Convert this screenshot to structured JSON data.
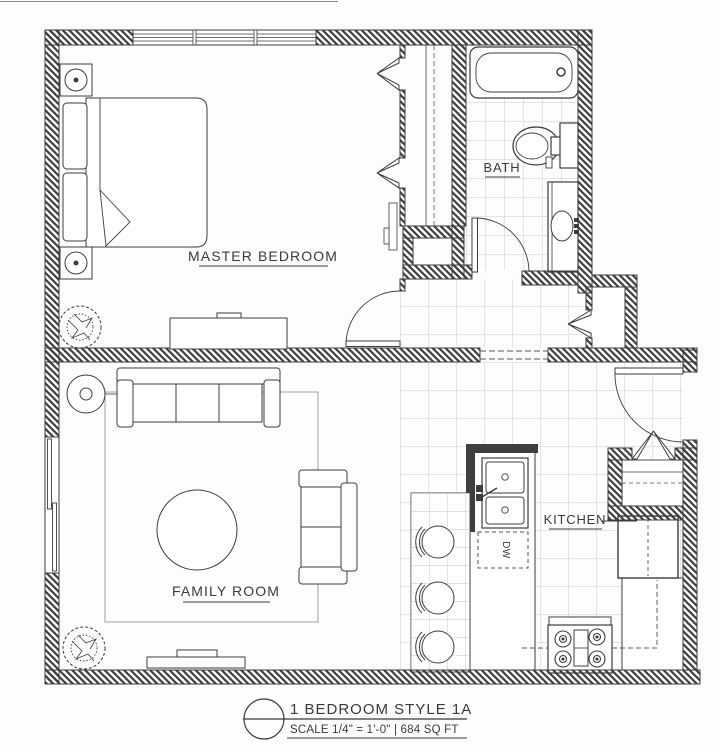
{
  "drawing": {
    "rooms": {
      "master_bedroom": "MASTER BEDROOM",
      "bath": "BATH",
      "family_room": "FAMILY ROOM",
      "kitchen": "KITCHEN"
    },
    "appliances": {
      "dishwasher": "DW"
    },
    "title_block": {
      "plan_name": "1 BEDROOM STYLE 1A",
      "scale_line": "SCALE 1/4\" = 1'-0\" | 684 SQ FT"
    },
    "colors": {
      "line": "#3c3c3c",
      "tile_line": "#b9b9b9",
      "background": "#fdfdfd"
    }
  }
}
